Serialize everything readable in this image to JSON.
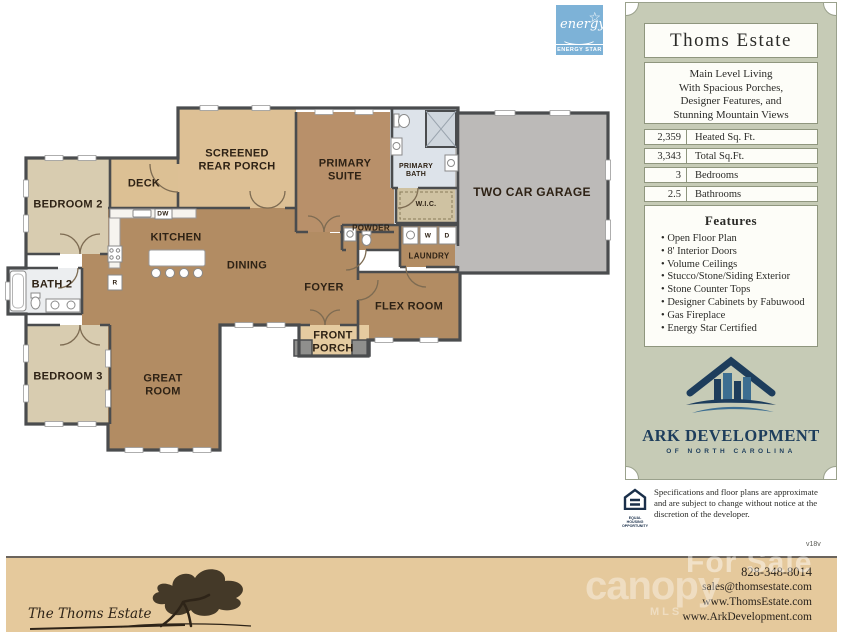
{
  "floor_plan": {
    "rooms": {
      "bedroom2": "BEDROOM 2",
      "deck": "DECK",
      "screened_porch": "SCREENED\nREAR PORCH",
      "primary_suite": "PRIMARY\nSUITE",
      "primary_bath": "PRIMARY\nBATH",
      "garage": "TWO CAR GARAGE",
      "kitchen": "KITCHEN",
      "dining": "DINING",
      "bath2": "BATH 2",
      "wic": "W.I.C.",
      "powder": "POWDER",
      "laundry": "LAUNDRY",
      "foyer": "FOYER",
      "flex": "FLEX ROOM",
      "bedroom3": "BEDROOM 3",
      "great_room": "GREAT\nROOM",
      "front_porch": "FRONT\nPORCH"
    },
    "appliances": {
      "dw": "DW",
      "r": "R",
      "w": "W",
      "d": "D"
    }
  },
  "energy_star": {
    "script": "energy",
    "star": "☆",
    "label": "ENERGY STAR"
  },
  "info_panel": {
    "title": "Thoms Estate",
    "description_lines": [
      "Main Level Living",
      "With Spacious Porches,",
      "Designer Features, and",
      "Stunning Mountain Views"
    ],
    "stats": [
      {
        "value": "2,359",
        "label": "Heated Sq. Ft."
      },
      {
        "value": "3,343",
        "label": "Total Sq.Ft."
      },
      {
        "value": "3",
        "label": "Bedrooms"
      },
      {
        "value": "2.5",
        "label": "Bathrooms"
      }
    ],
    "features": {
      "title": "Features",
      "items": [
        "Open Floor Plan",
        "8' Interior Doors",
        "Volume Ceilings",
        "Stucco/Stone/Siding Exterior",
        "Stone Counter Tops",
        "Designer Cabinets by Fabuwood",
        "Gas Fireplace",
        "Energy Star Certified"
      ]
    },
    "logo": {
      "name": "ARK DEVELOPMENT",
      "subtitle": "OF  NORTH  CAROLINA"
    }
  },
  "disclaimer": {
    "equal_housing": "EQUAL HOUSING OPPORTUNITY",
    "text": "Specifications and floor plans are approximate and are subject to change without notice at the discretion of the developer.",
    "version": "v18v"
  },
  "footer": {
    "script_name": "The Thoms Estate",
    "phone": "828-348-8014",
    "email": "sales@thomsestate.com",
    "website1": "www.ThomsEstate.com",
    "website2": "www.ArkDevelopment.com",
    "watermark_for_sale": "For Sale",
    "watermark_canopy": "canopy",
    "watermark_mls": "MLS"
  },
  "colors": {
    "living_brown": "#b28c63",
    "bedroom_beige": "#d8ccb0",
    "porch_tan": "#ddc095",
    "garage_gray": "#bcbab8",
    "bath_tile": "#dde3ea",
    "wall": "#4a4c4e",
    "panel_green": "#c6cbb6",
    "footer_tan": "#e5c99c",
    "ark_navy": "#1d3d5c",
    "energy_blue": "#7db2d7"
  }
}
